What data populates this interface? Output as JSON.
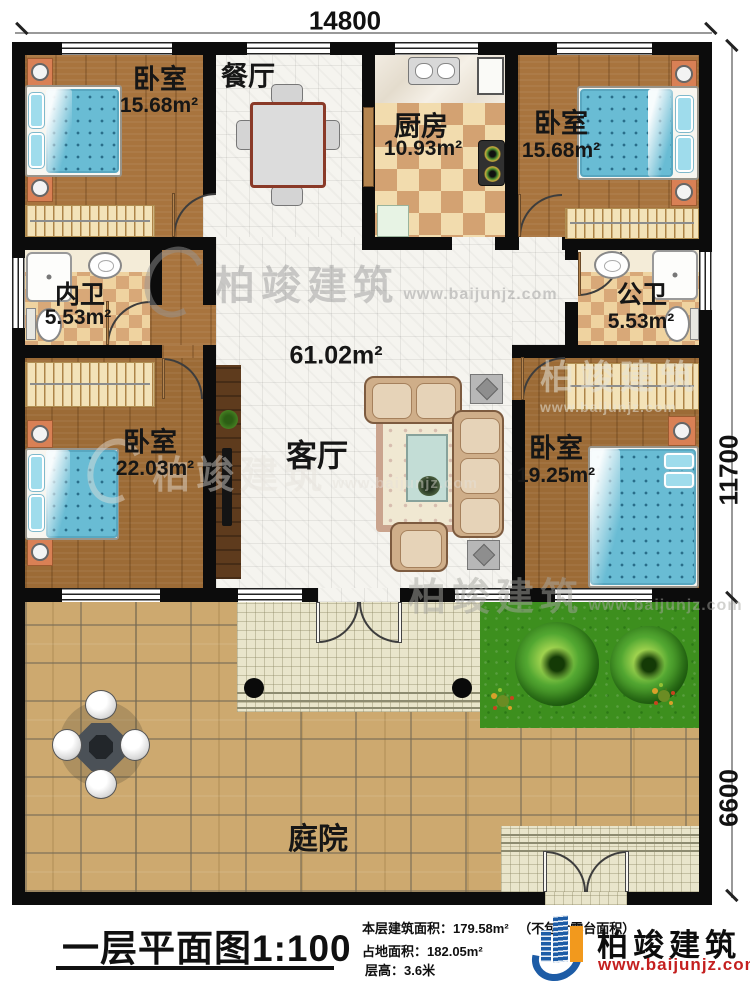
{
  "dimensions": {
    "top": "14800",
    "side_upper": "11700",
    "side_lower": "6600"
  },
  "rooms": {
    "bedroom_tl": {
      "name": "卧室",
      "area": "15.68m²"
    },
    "dining": {
      "name": "餐厅"
    },
    "kitchen": {
      "name": "厨房",
      "area": "10.93m²"
    },
    "bedroom_tr": {
      "name": "卧室",
      "area": "15.68m²"
    },
    "bath_inner": {
      "name": "内卫",
      "area": "5.53m²"
    },
    "bath_public": {
      "name": "公卫",
      "area": "5.53m²"
    },
    "living": {
      "name": "客厅",
      "area": "61.02m²"
    },
    "bedroom_bl": {
      "name": "卧室",
      "area": "22.03m²"
    },
    "bedroom_br": {
      "name": "卧室",
      "area": "19.25m²"
    },
    "courtyard": {
      "name": "庭院"
    }
  },
  "watermark": {
    "company": "柏竣建筑",
    "website": "www.baijunjz.com"
  },
  "footer": {
    "plan_title": "一层平面图1:100",
    "stat_area_label": "本层建筑面积：",
    "stat_area_value": "179.58m²",
    "stat_area_note": "（不包含露台面积）",
    "stat_land_label": "占地面积：",
    "stat_land_value": "182.05m²",
    "stat_height_label": "层高：",
    "stat_height_value": "3.6米",
    "logo_company": "柏竣建筑",
    "logo_website": "www.baijunjz.com"
  },
  "colors": {
    "accent_red": "#c41f1f",
    "logo_blue": "#1d5ca6",
    "logo_orange": "#f2991d"
  }
}
